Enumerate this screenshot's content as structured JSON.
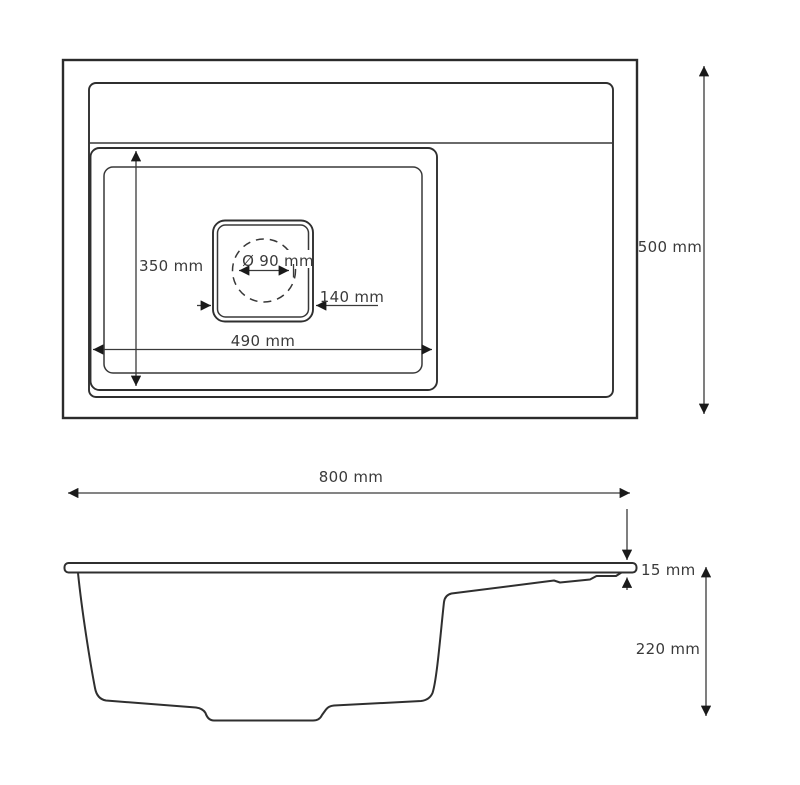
{
  "drawing": {
    "views": {
      "top_view": "sink top view",
      "side_view": "sink side profile view"
    },
    "dimensions": {
      "overall_depth": "500 mm",
      "bowl_depth_front_back": "350 mm",
      "drain_diameter": "Ø 90 mm",
      "drain_flange_width": "140 mm",
      "bowl_width": "490 mm",
      "overall_width": "800 mm",
      "rim_thickness": "15 mm",
      "body_height": "220 mm"
    }
  }
}
